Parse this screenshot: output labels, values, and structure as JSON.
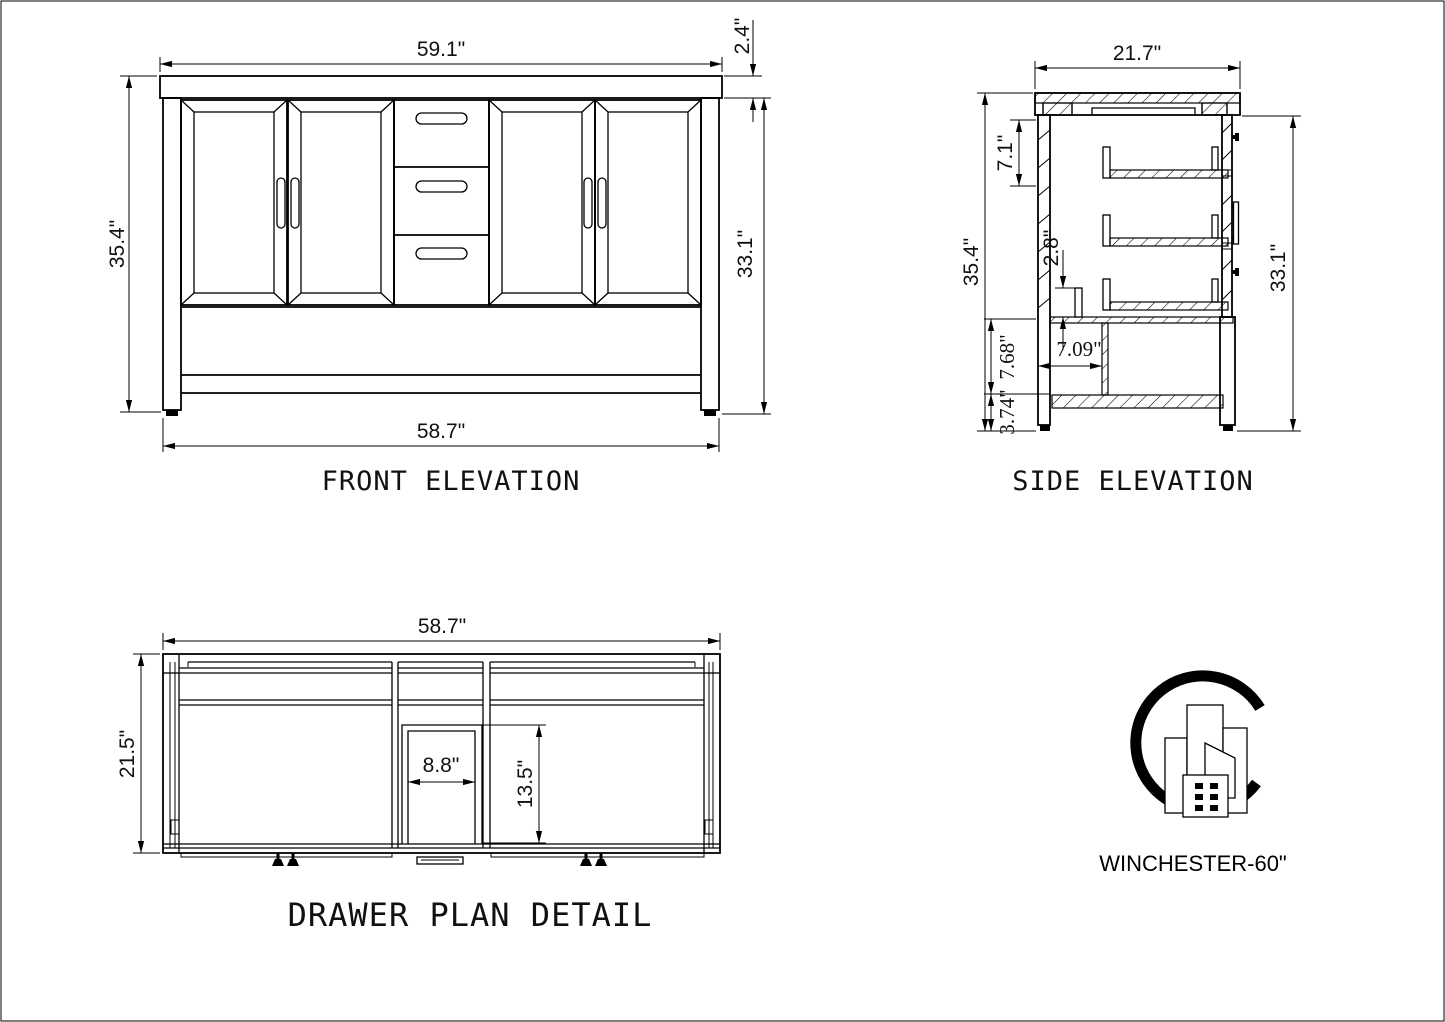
{
  "front": {
    "title": "FRONT ELEVATION",
    "dims": {
      "counter_width": "59.1\"",
      "counter_thickness": "2.4\"",
      "overall_height": "35.4\"",
      "cabinet_height": "33.1\"",
      "base_width": "58.7\""
    }
  },
  "side": {
    "title": "SIDE ELEVATION",
    "dims": {
      "depth": "21.7\"",
      "top_drawer_zone": "7.1\"",
      "stretcher_height": "2.8\"",
      "overall_height": "35.4\"",
      "cabinet_height": "33.1\"",
      "shelf_clearance": "7.68\"",
      "leg_height": "3.74\"",
      "shelf_depth": "7.09\""
    }
  },
  "plan": {
    "title": "DRAWER PLAN DETAIL",
    "dims": {
      "width": "58.7\"",
      "depth": "21.5\"",
      "drawer_width": "8.8\"",
      "drawer_depth": "13.5\""
    }
  },
  "logo": {
    "label": "WINCHESTER-60\""
  },
  "colors": {
    "line": "#000000",
    "background": "#ffffff"
  }
}
